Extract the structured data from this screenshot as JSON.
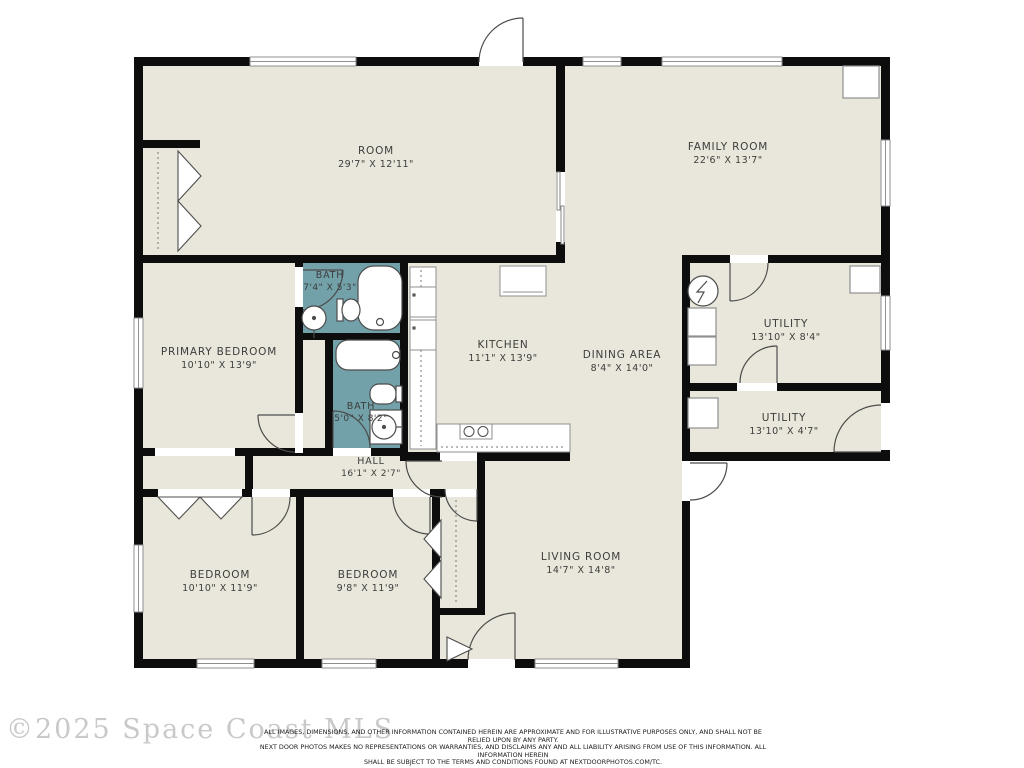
{
  "colors": {
    "floor": "#e9e7db",
    "bath": "#72a1a9",
    "wall": "#0d0d0d",
    "fixture_outline": "#4c4c4c",
    "window_outline": "#8f8f8f",
    "label_text": "#3d3d3d",
    "watermark_text": "#c9c9c9"
  },
  "rooms": {
    "room": {
      "name": "ROOM",
      "dims": "29'7\" X 12'11\""
    },
    "family_room": {
      "name": "FAMILY ROOM",
      "dims": "22'6\" X 13'7\""
    },
    "bath1": {
      "name": "BATH",
      "dims": "7'4\" X 5'3\""
    },
    "primary_bedroom": {
      "name": "PRIMARY BEDROOM",
      "dims": "10'10\" X 13'9\""
    },
    "kitchen": {
      "name": "KITCHEN",
      "dims": "11'1\" X 13'9\""
    },
    "dining_area": {
      "name": "DINING AREA",
      "dims": "8'4\" X 14'0\""
    },
    "utility1": {
      "name": "UTILITY",
      "dims": "13'10\" X 8'4\""
    },
    "bath2": {
      "name": "BATH",
      "dims": "5'0\" X 8'2\""
    },
    "utility2": {
      "name": "UTILITY",
      "dims": "13'10\" X 4'7\""
    },
    "hall": {
      "name": "HALL",
      "dims": "16'1\" X 2'7\""
    },
    "bedroom1": {
      "name": "BEDROOM",
      "dims": "10'10\" X 11'9\""
    },
    "bedroom2": {
      "name": "BEDROOM",
      "dims": "9'8\" X 11'9\""
    },
    "living_room": {
      "name": "LIVING ROOM",
      "dims": "14'7\" X 14'8\""
    }
  },
  "watermark": "©2025 Space Coast MLS",
  "disclaimer": {
    "line1": "ALL IMAGES, DIMENSIONS, AND OTHER INFORMATION CONTAINED HEREIN ARE APPROXIMATE AND FOR ILLUSTRATIVE PURPOSES ONLY, AND SHALL NOT BE RELIED UPON BY ANY PARTY.",
    "line2": "NEXT DOOR PHOTOS MAKES NO REPRESENTATIONS OR WARRANTIES, AND DISCLAIMS ANY AND ALL LIABILITY ARISING FROM USE OF THIS INFORMATION. ALL INFORMATION HEREIN",
    "line3": "SHALL BE SUBJECT TO THE TERMS AND CONDITIONS FOUND AT NEXTDOORPHOTOS.COM/TC."
  }
}
